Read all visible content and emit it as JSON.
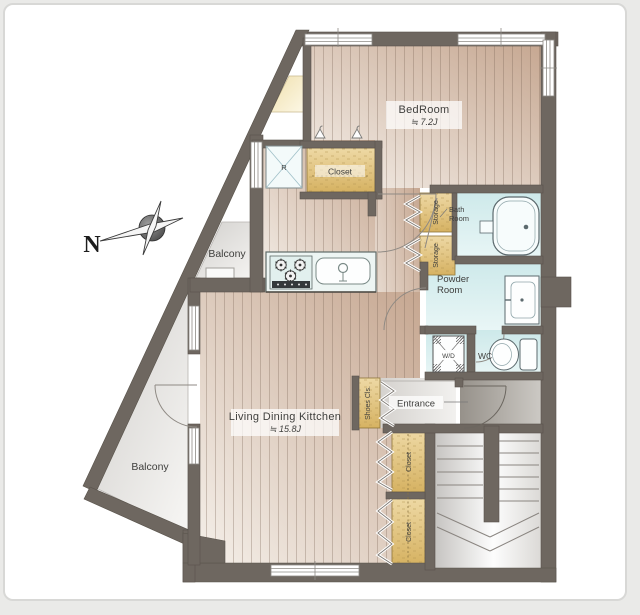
{
  "compass": {
    "north_label": "N"
  },
  "rooms": {
    "bedroom": {
      "name": "BedRoom",
      "area": "≒ 7.2J"
    },
    "ldk": {
      "name": "Living Dining Kittchen",
      "area": "≒ 15.8J"
    },
    "bath": {
      "line1": "Bath",
      "line2": "Room"
    },
    "powder": {
      "line1": "Powder",
      "line2": "Room"
    },
    "wc": {
      "name": "WC"
    },
    "washer_dryer": {
      "name": "W/D"
    },
    "entrance": {
      "name": "Entrance"
    },
    "balcony_upper": {
      "name": "Balcony"
    },
    "balcony_lower": {
      "name": "Balcony"
    },
    "closet_top": {
      "name": "Closet"
    },
    "closet_mid": {
      "name": "Closet"
    },
    "closet_bottom": {
      "name": "Closet"
    },
    "shoes_closet": {
      "name": "Shoes Cls."
    },
    "storage_upper": {
      "name": "Storage"
    },
    "storage_lower": {
      "name": "Storage"
    },
    "refrigerator": {
      "name": "R"
    }
  },
  "colors": {
    "wall": "#6e6760",
    "wood_floor": "#e6d9cf",
    "closet_tan": "#e2c683",
    "wet_room": "#d5ecec",
    "balcony": "#e8e6e3",
    "label_text": "#3f3f3d"
  }
}
